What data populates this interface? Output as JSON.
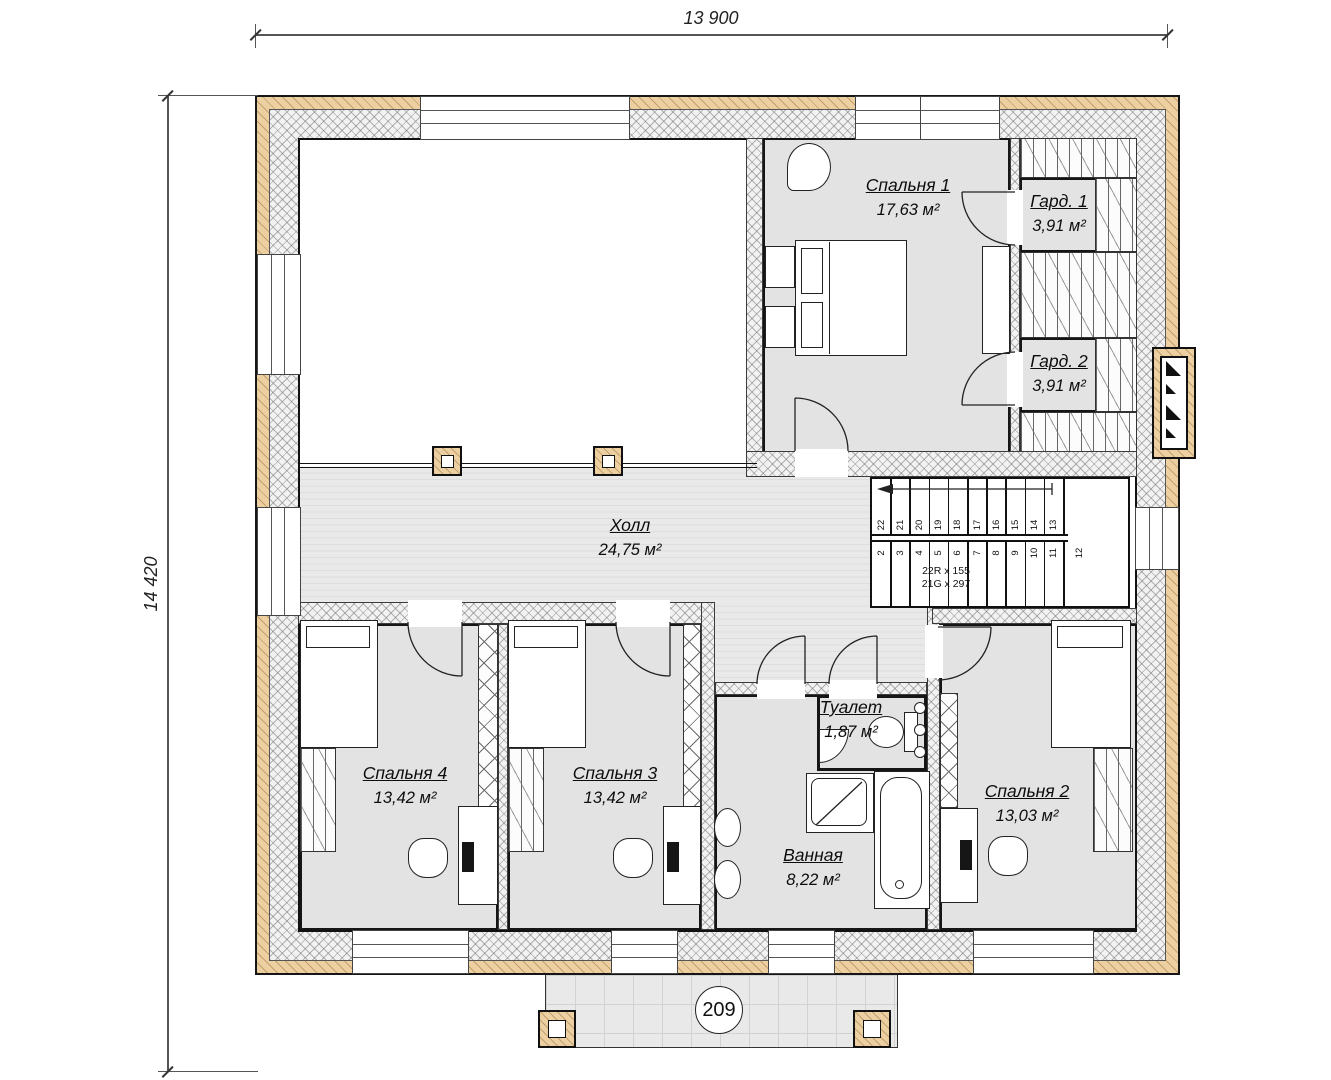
{
  "plan": {
    "dimensions": {
      "width_label": "13 900",
      "height_label": "14 420"
    },
    "terrace_number": "209",
    "rooms": [
      {
        "name": "Спальня 1",
        "area": "17,63 м²"
      },
      {
        "name": "Гард. 1",
        "area": "3,91 м²"
      },
      {
        "name": "Гард. 2",
        "area": "3,91 м²"
      },
      {
        "name": "Холл",
        "area": "24,75 м²"
      },
      {
        "name": "Спальня 4",
        "area": "13,42 м²"
      },
      {
        "name": "Спальня 3",
        "area": "13,42 м²"
      },
      {
        "name": "Туалет",
        "area": "1,87 м²"
      },
      {
        "name": "Ванная",
        "area": "8,22 м²"
      },
      {
        "name": "Спальня 2",
        "area": "13,03 м²"
      }
    ],
    "stairs": {
      "upper_treads": [
        "22",
        "21",
        "20",
        "19",
        "18",
        "17",
        "16",
        "15",
        "14",
        "13"
      ],
      "lower_treads": [
        "2",
        "3",
        "4",
        "5",
        "6",
        "7",
        "8",
        "9",
        "10",
        "11"
      ],
      "landing_tread": "12",
      "note": [
        "22R x 155",
        "21G x 297"
      ]
    },
    "colors": {
      "wood_accent": "#edd0a2",
      "room_fill": "#e3e3e3",
      "line": "#111111"
    }
  }
}
